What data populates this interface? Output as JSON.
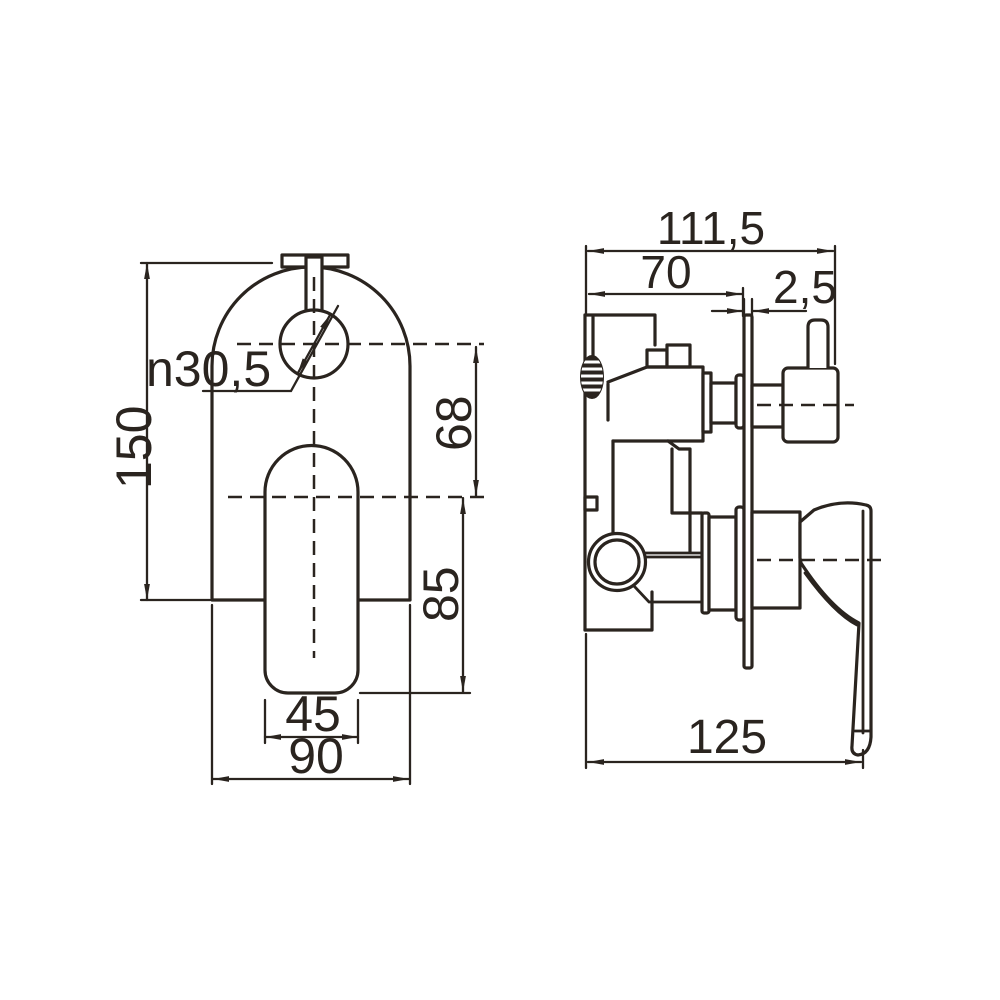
{
  "drawing_title": "shower mixer technical drawing",
  "colors": {
    "background": "#ffffff",
    "line": "#2a241f"
  },
  "front_view": {
    "name": "front-view",
    "dim_height": "150",
    "dim_width": "90",
    "dim_handle_width": "45",
    "dim_hole_diameter": "n30,5",
    "dim_hole_spacing": "68",
    "dim_center_to_handle_end": "85"
  },
  "side_view": {
    "name": "side-view",
    "dim_overall_depth": "111,5",
    "dim_body_depth": "70",
    "dim_plate_thickness": "2,5",
    "dim_depth_with_handle": "125"
  }
}
